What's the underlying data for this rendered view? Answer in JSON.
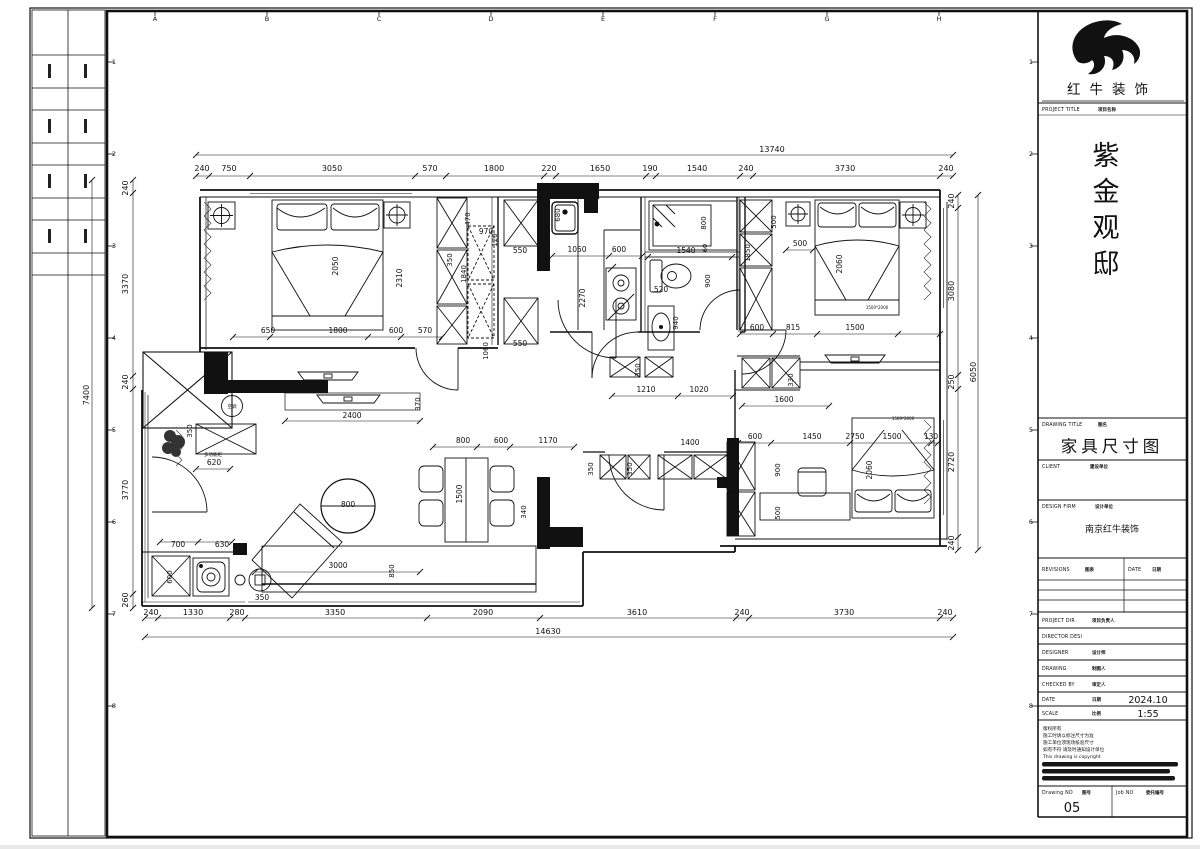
{
  "title_block": {
    "brand": "红牛装饰",
    "project_title_en": "PROJECT TITLE",
    "project_title_cn": "项目名称",
    "project_name": "紫金观邸",
    "drawing_title_en": "DRAWING TITLE",
    "drawing_title_cn": "图名",
    "drawing_title": "家具尺寸图",
    "client_en": "CLIENT",
    "client_cn": "建设单位",
    "design_firm_en": "DESIGN FIRM",
    "design_firm_cn": "设计单位",
    "design_firm": "南京红牛装饰",
    "revisions_en": "REVISIONS",
    "revisions_cn": "图表",
    "rev_date_en": "DATE",
    "rev_date_cn": "日期",
    "project_dir_en": "PROJECT DIR",
    "project_dir_cn": "项目负责人",
    "director_en": "DIRECTOR DESI",
    "designer_en": "DESIGNER",
    "designer_cn": "设计师",
    "drawing_by_en": "DRAWING",
    "drawing_by_cn": "制图人",
    "checked_en": "CHECKED BY",
    "checked_cn": "审定人",
    "date_en": "DATE",
    "date_cn": "日期",
    "date": "2024.10",
    "scale_en": "SCALE",
    "scale_cn": "比例",
    "scale": "1:55",
    "notes": [
      "版权所有",
      "施工时请以标注尺寸为准",
      "施工单位须现场核验尺寸",
      "如有不符 请及时通知设计单位",
      "This drawing is copyright"
    ],
    "drawing_no_en": "Drawing NO",
    "drawing_no_cn": "图号",
    "drawing_no": "05",
    "job_no_en": "Job NO",
    "job_no_cn": "委托编号"
  },
  "grid": {
    "letters": [
      "A",
      "B",
      "C",
      "D",
      "E",
      "F",
      "G",
      "H"
    ],
    "numbers": [
      "1",
      "2",
      "3",
      "4",
      "5",
      "6",
      "7",
      "8"
    ]
  },
  "plan": {
    "dims": {
      "top": {
        "overall": "13740",
        "segments": [
          "240",
          "750",
          "3050",
          "570",
          "1800",
          "220",
          "1650",
          "190",
          "1540",
          "240",
          "3730",
          "240"
        ]
      },
      "bottom": {
        "overall": "14630",
        "segments": [
          "240",
          "1330",
          "280",
          "3350",
          "2090",
          "3610",
          "240",
          "3730",
          "240"
        ]
      },
      "left": {
        "overall": "7400",
        "segments": [
          "240",
          "3370",
          "240",
          "3770",
          "260"
        ]
      },
      "right": {
        "overall": "6050",
        "segments": [
          "240",
          "3080",
          "250",
          "2720",
          "240"
        ]
      }
    },
    "annotations": {
      "ac_unit": "空调",
      "multi_cabinet": "多功能柜",
      "bed_size_note": "1500*2000"
    },
    "texts": [
      [
        "240",
        202,
        171
      ],
      [
        "750",
        229,
        171
      ],
      [
        "3050",
        332,
        171
      ],
      [
        "570",
        430,
        171
      ],
      [
        "1800",
        494,
        171
      ],
      [
        "220",
        549,
        171
      ],
      [
        "1650",
        600,
        171
      ],
      [
        "190",
        650,
        171
      ],
      [
        "1540",
        697,
        171
      ],
      [
        "240",
        746,
        171
      ],
      [
        "3730",
        845,
        171
      ],
      [
        "240",
        946,
        171
      ],
      [
        "13740",
        772,
        152
      ],
      [
        "240",
        151,
        615
      ],
      [
        "1330",
        193,
        615
      ],
      [
        "280",
        237,
        615
      ],
      [
        "3350",
        335,
        615
      ],
      [
        "2090",
        483,
        615
      ],
      [
        "3610",
        637,
        615
      ],
      [
        "240",
        742,
        615
      ],
      [
        "3730",
        844,
        615
      ],
      [
        "240",
        945,
        615
      ],
      [
        "14630",
        548,
        634
      ],
      [
        "240",
        128,
        188,
        -90
      ],
      [
        "3370",
        128,
        284,
        -90
      ],
      [
        "240",
        128,
        382,
        -90
      ],
      [
        "3770",
        128,
        490,
        -90
      ],
      [
        "260",
        128,
        600,
        -90
      ],
      [
        "7400",
        89,
        395,
        -90
      ],
      [
        "240",
        954,
        201,
        -90
      ],
      [
        "3080",
        954,
        291,
        -90
      ],
      [
        "250",
        954,
        382,
        -90
      ],
      [
        "2720",
        954,
        462,
        -90
      ],
      [
        "240",
        954,
        543,
        -90
      ],
      [
        "6050",
        976,
        372,
        -90
      ],
      [
        "2050",
        338,
        266,
        -90,
        7.5
      ],
      [
        "2310",
        402,
        278,
        -90,
        7.5
      ],
      [
        "650",
        268,
        333,
        0,
        7.5
      ],
      [
        "1800",
        338,
        333,
        0,
        7.5
      ],
      [
        "600",
        396,
        333,
        0,
        7.5
      ],
      [
        "570",
        425,
        333,
        0,
        7.5
      ],
      [
        "350",
        452,
        260,
        -90,
        7
      ],
      [
        "1840",
        466,
        274,
        -90,
        7
      ],
      [
        "470",
        470,
        219,
        -90,
        7
      ],
      [
        "970",
        486,
        234,
        0,
        7.5
      ],
      [
        "120",
        497,
        240,
        -90,
        7
      ],
      [
        "550",
        520,
        253,
        0,
        7.5
      ],
      [
        "550",
        520,
        346,
        0,
        7.5
      ],
      [
        "1060",
        488,
        351,
        -90,
        7
      ],
      [
        "680",
        560,
        215,
        -90,
        7
      ],
      [
        "1050",
        577,
        252,
        0,
        7.5
      ],
      [
        "600",
        619,
        252,
        0,
        7.5
      ],
      [
        "2270",
        585,
        298,
        -90,
        7.5
      ],
      [
        "800",
        706,
        223,
        -90,
        7
      ],
      [
        "1540",
        686,
        253,
        0,
        7.5
      ],
      [
        "60",
        707,
        248,
        -90,
        6.5
      ],
      [
        "520",
        661,
        292,
        0,
        7.5
      ],
      [
        "900",
        710,
        281,
        -90,
        7
      ],
      [
        "940",
        678,
        323,
        -90,
        7
      ],
      [
        "1210",
        646,
        392,
        0,
        7.5
      ],
      [
        "1020",
        699,
        392,
        0,
        7.5
      ],
      [
        "350",
        640,
        370,
        -90,
        7
      ],
      [
        "330",
        793,
        380,
        -90,
        7
      ],
      [
        "1600",
        784,
        402,
        0,
        7.5
      ],
      [
        "600",
        755,
        439,
        0,
        7.5
      ],
      [
        "1450",
        812,
        439,
        0,
        7.5
      ],
      [
        "2750",
        855,
        439,
        0,
        7.5
      ],
      [
        "1500",
        892,
        439,
        0,
        7.5
      ],
      [
        "130",
        931,
        439,
        0,
        7.5
      ],
      [
        "900",
        780,
        470,
        -90,
        7
      ],
      [
        "500",
        780,
        513,
        -90,
        7
      ],
      [
        "2060",
        872,
        470,
        -90,
        7.5
      ],
      [
        "1500*2000",
        903,
        420,
        0,
        4,
        "#b22222"
      ],
      [
        "1850",
        750,
        253,
        -90,
        7
      ],
      [
        "500",
        776,
        222,
        -90,
        7
      ],
      [
        "500",
        800,
        246,
        0,
        7.5
      ],
      [
        "2060",
        842,
        264,
        -90,
        7.5
      ],
      [
        "1500*2000",
        877,
        309,
        0,
        4,
        "#b22222"
      ],
      [
        "600",
        757,
        330,
        0,
        7.5
      ],
      [
        "815",
        793,
        330,
        0,
        7.5
      ],
      [
        "1500",
        855,
        330,
        0,
        7.5
      ],
      [
        "2400",
        352,
        418,
        0,
        7.5
      ],
      [
        "370",
        420,
        404,
        -90,
        7
      ],
      [
        "多功能柜",
        213,
        456,
        0,
        4.5
      ],
      [
        "620",
        214,
        465,
        0,
        7.5
      ],
      [
        "空调",
        232,
        408,
        0,
        4.5
      ],
      [
        "350",
        192,
        431,
        -90,
        7
      ],
      [
        "800",
        348,
        507,
        0,
        7.5
      ],
      [
        "3000",
        338,
        568,
        0,
        7.5
      ],
      [
        "850",
        394,
        571,
        -90,
        7
      ],
      [
        "350",
        262,
        600,
        0,
        7.5
      ],
      [
        "700",
        178,
        547,
        0,
        7.5
      ],
      [
        "630",
        222,
        547,
        0,
        7.5
      ],
      [
        "600",
        172,
        577,
        -90,
        7
      ],
      [
        "800",
        463,
        443,
        0,
        7.5
      ],
      [
        "600",
        501,
        443,
        0,
        7.5
      ],
      [
        "1170",
        548,
        443,
        0,
        7.5
      ],
      [
        "1500",
        462,
        494,
        -90,
        7.5
      ],
      [
        "340",
        526,
        512,
        -90,
        7
      ],
      [
        "350",
        593,
        469,
        -90,
        7
      ],
      [
        "350",
        632,
        469,
        -90,
        7
      ],
      [
        "1400",
        690,
        445,
        0,
        7.5
      ]
    ],
    "dimlines": [
      [
        196,
        155,
        953,
        155,
        [
          196,
          953
        ]
      ],
      [
        196,
        176,
        953,
        176,
        [
          196,
          209,
          250,
          415,
          446,
          544,
          556,
          646,
          656,
          740,
          753,
          940,
          953
        ]
      ],
      [
        145,
        618,
        953,
        618,
        [
          145,
          158,
          230,
          245,
          427,
          540,
          736,
          749,
          940,
          953
        ]
      ],
      [
        145,
        637,
        953,
        637,
        [
          145,
          953
        ]
      ],
      [
        92,
        180,
        92,
        608,
        [
          180,
          608
        ]
      ],
      [
        133,
        180,
        133,
        608,
        [
          180,
          193,
          376,
          389,
          594,
          608
        ]
      ],
      [
        958,
        195,
        958,
        550,
        [
          195,
          208,
          375,
          389,
          537,
          550
        ]
      ],
      [
        978,
        195,
        978,
        550,
        [
          195,
          550
        ]
      ],
      [
        233,
        337,
        442,
        337,
        [
          233,
          270,
          368,
          401,
          442
        ]
      ],
      [
        285,
        421,
        420,
        421,
        [
          285,
          420
        ]
      ],
      [
        433,
        447,
        574,
        447,
        [
          433,
          477,
          510,
          574
        ]
      ],
      [
        255,
        572,
        420,
        572,
        [
          255,
          420
        ]
      ],
      [
        160,
        542,
        232,
        542,
        [
          160,
          198,
          232
        ]
      ],
      [
        196,
        469,
        230,
        469,
        [
          196,
          230
        ]
      ],
      [
        552,
        256,
        642,
        256,
        [
          552,
          609,
          642
        ]
      ],
      [
        648,
        257,
        732,
        257,
        [
          648,
          732
        ]
      ],
      [
        612,
        396,
        733,
        396,
        [
          612,
          678,
          733
        ]
      ],
      [
        742,
        406,
        829,
        406,
        [
          742,
          829
        ]
      ],
      [
        740,
        334,
        940,
        334,
        [
          740,
          773,
          817,
          898,
          940
        ]
      ],
      [
        738,
        443,
        938,
        443,
        [
          738,
          771,
          850,
          931,
          938
        ]
      ],
      [
        786,
        250,
        813,
        250,
        [
          786,
          813
        ]
      ]
    ]
  }
}
